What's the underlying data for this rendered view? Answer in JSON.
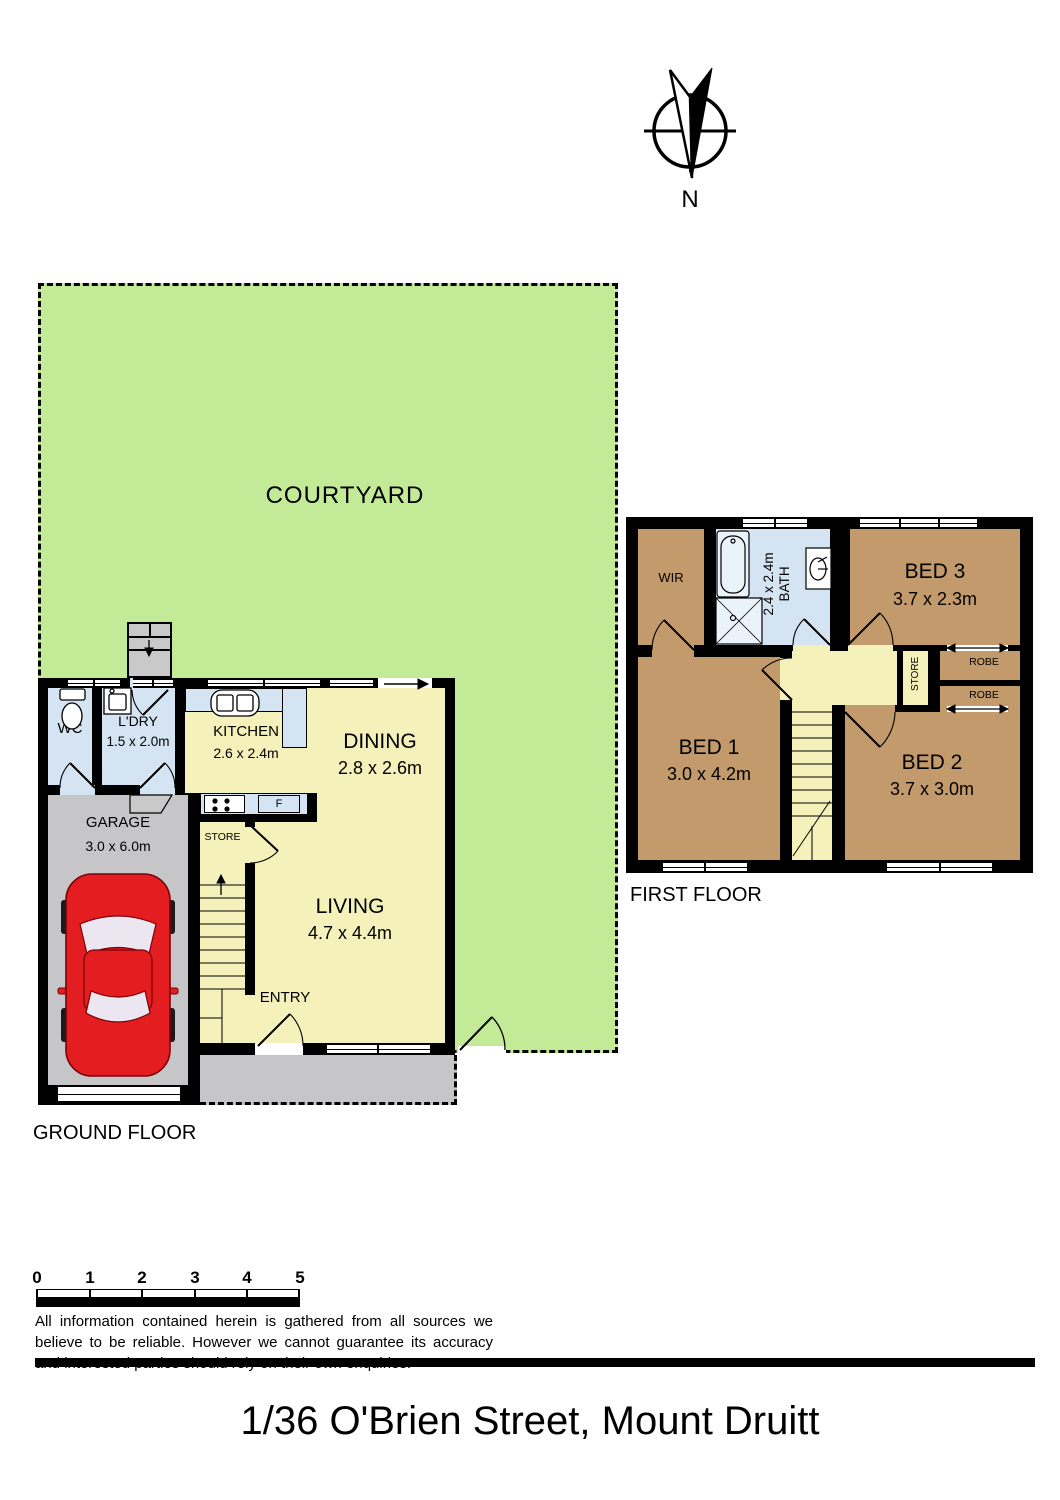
{
  "title": "1/36 O'Brien Street, Mount Druitt",
  "compass": {
    "label": "N"
  },
  "courtyard": {
    "label": "COURTYARD"
  },
  "ground_floor": {
    "label": "GROUND FLOOR",
    "rooms": {
      "wc": {
        "name": "WC"
      },
      "laundry": {
        "name": "L'DRY",
        "dims": "1.5 x 2.0m"
      },
      "kitchen": {
        "name": "KITCHEN",
        "dims": "2.6 x 2.4m"
      },
      "dining": {
        "name": "DINING",
        "dims": "2.8 x 2.6m"
      },
      "garage": {
        "name": "GARAGE",
        "dims": "3.0 x 6.0m"
      },
      "store": {
        "name": "STORE"
      },
      "living": {
        "name": "LIVING",
        "dims": "4.7 x 4.4m"
      },
      "entry": {
        "name": "ENTRY"
      },
      "fridge_label": "F"
    }
  },
  "first_floor": {
    "label": "FIRST FLOOR",
    "rooms": {
      "wir": {
        "name": "WIR"
      },
      "bath": {
        "name": "BATH",
        "dims": "2.4 x 2.4m"
      },
      "bed3": {
        "name": "BED 3",
        "dims": "3.7 x 2.3m"
      },
      "bed1": {
        "name": "BED 1",
        "dims": "3.0 x 4.2m"
      },
      "bed2": {
        "name": "BED 2",
        "dims": "3.7 x 3.0m"
      },
      "robe_top": {
        "name": "ROBE"
      },
      "robe_bottom": {
        "name": "ROBE"
      },
      "store": {
        "name": "STORE"
      }
    }
  },
  "scale_bar": {
    "ticks": [
      "0",
      "1",
      "2",
      "3",
      "4",
      "5"
    ]
  },
  "disclaimer": "All information contained herein is gathered from all sources we believe to be reliable. However we cannot guarantee its accuracy and interested parties should rely on their own enquiries.",
  "colors": {
    "courtyard_green": "#c3ea96",
    "room_yellow": "#f5f1ba",
    "wet_area_blue": "#d5e4f2",
    "bedroom_brown": "#c29a6b",
    "garage_gray": "#c6c6c8",
    "car_red": "#e41e20",
    "wall_black": "#000000"
  }
}
